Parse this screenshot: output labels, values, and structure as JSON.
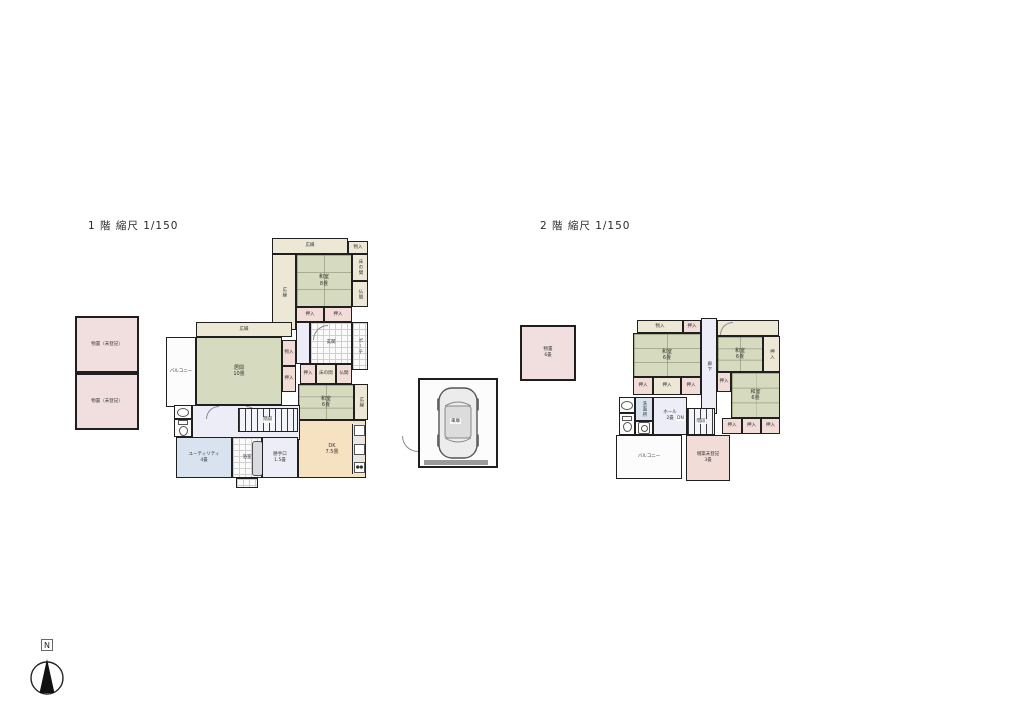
{
  "colors": {
    "wall": "#1f1f1f",
    "tatami": "#d6dabf",
    "cream": "#ece8d5",
    "pink": "#f2dcd7",
    "tan": "#f6e1c1",
    "blue": "#d9e3f0",
    "hall": "#ecedf6",
    "storage": "#f1dfdf"
  },
  "floor1": {
    "title": "1 階 縮尺 1/150",
    "storage_upper": "物置（未登記）",
    "storage_lower": "物置（未登記）",
    "engawa_top": "広縁",
    "engawa_left": "広縁",
    "monoire_top": "物入",
    "washitsu8": {
      "name": "和室",
      "size": "8畳"
    },
    "tokonoma": "床の間",
    "butsuma": "仏間",
    "oshiire_a": "押入",
    "oshiire_b": "押入",
    "genkan": "玄関",
    "porch": "ポーチ",
    "oshiire_c": "押入",
    "tokonoma2": "床の間",
    "butsuma2": "仏間",
    "washitsu6": {
      "name": "和室",
      "size": "6畳"
    },
    "engawa_right": "広縁",
    "dk": {
      "name": "DK",
      "size": "7.5畳"
    },
    "hiroen_mid": "広縁",
    "ima": {
      "name": "居間",
      "size": "10畳"
    },
    "balcony": "バルコニー",
    "monoire_mid": "物入",
    "oshiire_mid": "押入",
    "senmen": "洗面",
    "toilet": "トイレ",
    "utility": {
      "name": "ユーティリティ",
      "size": "4畳"
    },
    "bath": "浴室",
    "katte": {
      "name": "勝手口",
      "size": "1.5畳"
    },
    "stairs": "階段"
  },
  "floor2": {
    "title": "2 階 縮尺 1/150",
    "storage": {
      "name": "物置",
      "size": "6畳"
    },
    "monoire": "物入",
    "oshiire_top": "押入",
    "washitsu_a": {
      "name": "和室",
      "size": "6畳"
    },
    "row1": [
      "押入",
      "押入",
      "押入"
    ],
    "rouka": "廊下",
    "washitsu_b": {
      "name": "和室",
      "size": "6畳"
    },
    "oshiire_side": "押入",
    "oshiire_small": "押入",
    "washitsu_c": {
      "name": "和室",
      "size": "6畳"
    },
    "row2": [
      "押入",
      "押入",
      "押入"
    ],
    "senmenjo": "洗面所",
    "hall": {
      "name": "ホール",
      "size": "2畳"
    },
    "dn": "DN",
    "stairs": "階段",
    "balcony": "バルコニー",
    "annex": {
      "name": "増築未登記",
      "size": "3畳"
    }
  },
  "garage": {
    "label": "車庫"
  },
  "compass": {
    "n": "N"
  }
}
